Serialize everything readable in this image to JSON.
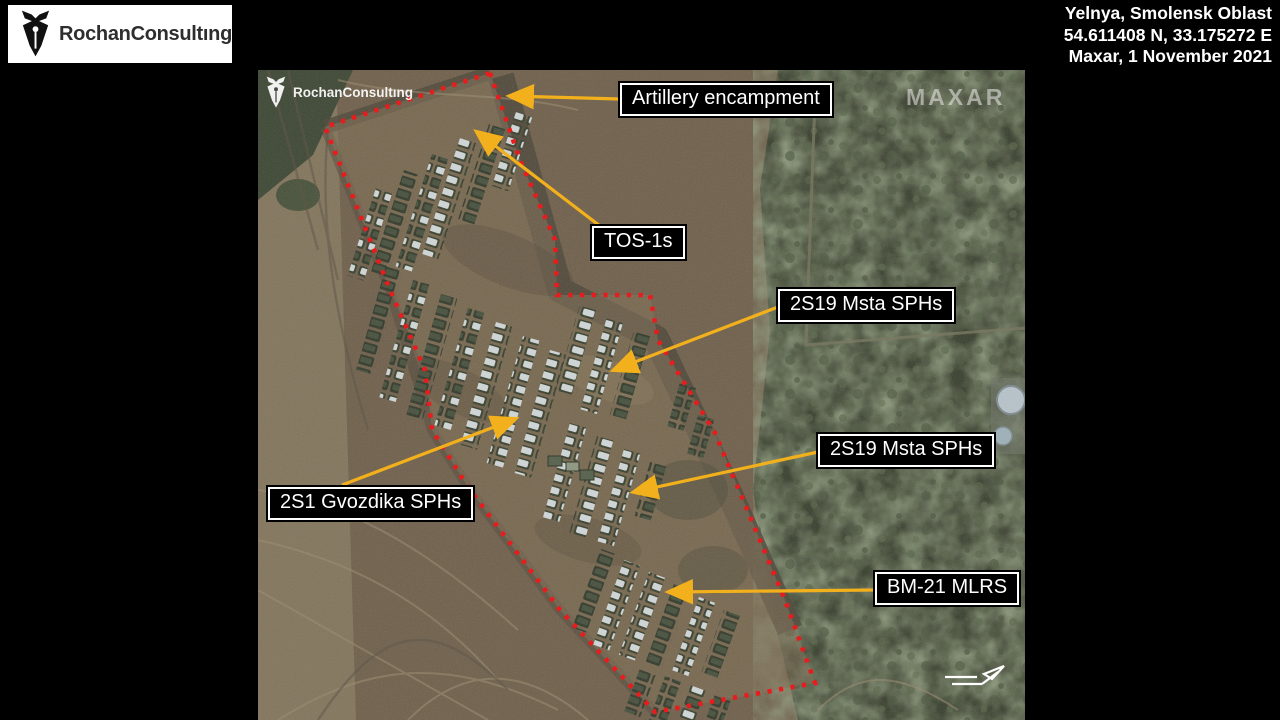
{
  "header": {
    "logo_text": "RochanConsultıng",
    "location_line1": "Yelnya, Smolensk Oblast",
    "location_line2": "54.611408 N, 33.175272 E",
    "location_line3": "Maxar, 1 November 2021"
  },
  "image": {
    "watermark_logo_text": "RochanConsultıng",
    "provider_watermark": "MAXAR",
    "outline_color": "#e81c1c",
    "arrow_color": "#f2b01c",
    "annotations": [
      {
        "id": "artillery",
        "label": "Artillery encampment"
      },
      {
        "id": "tos1",
        "label": "TOS-1s"
      },
      {
        "id": "msta1",
        "label": "2S19 Msta SPHs"
      },
      {
        "id": "gvozdika",
        "label": "2S1 Gvozdika SPHs"
      },
      {
        "id": "msta2",
        "label": "2S19 Msta SPHs"
      },
      {
        "id": "bm21",
        "label": "BM-21 MLRS"
      }
    ],
    "icons": {
      "logo_icon": "pen-nib-icon",
      "direction_icon": "north-arrow-icon"
    }
  }
}
